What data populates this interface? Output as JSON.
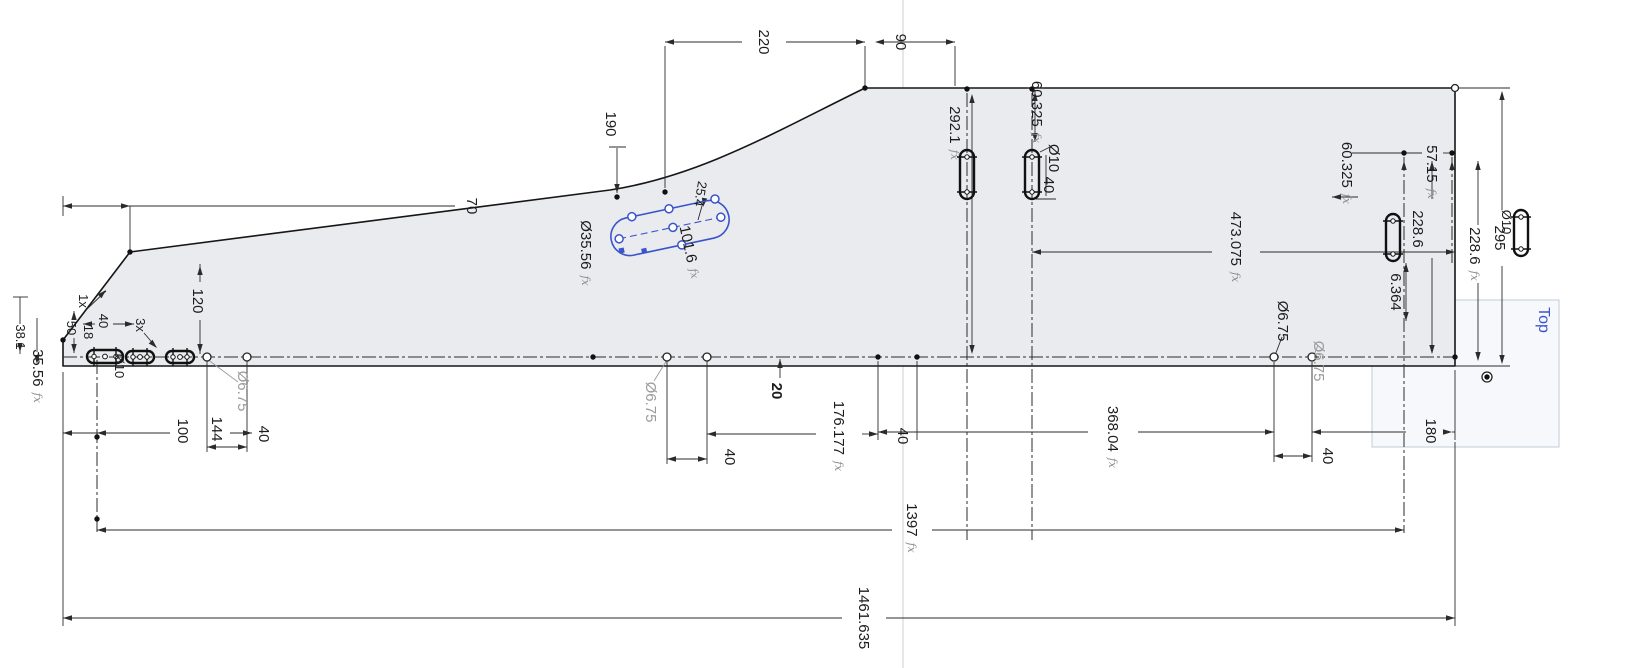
{
  "view": {
    "width": 1625,
    "height": 668,
    "background": "#ffffff"
  },
  "colors": {
    "outline": "#161616",
    "dim": "#2b2b2b",
    "gray_label": "#9b9b9b",
    "fx": "#8f8f8f",
    "blue": "#3a55cc",
    "fill": "#e9ebee",
    "axis": "#d4d7da",
    "plane_fill": "#eef3f8",
    "plane_stroke": "#c2cbd8"
  },
  "plane_label": {
    "text": "Top"
  },
  "labels": [
    {
      "name": "dim-70",
      "text": "70",
      "x": 472,
      "y": 206
    },
    {
      "name": "dim-190",
      "text": "190",
      "x": 611,
      "y": 124
    },
    {
      "name": "dim-220",
      "text": "220",
      "x": 764,
      "y": 42
    },
    {
      "name": "dim-90",
      "text": "90",
      "x": 901,
      "y": 42
    },
    {
      "name": "dim-25.4",
      "text": "25.4",
      "x": 701,
      "y": 194,
      "size": 13,
      "rot": 100
    },
    {
      "name": "dim-dia35.56",
      "text": "Ø35.56",
      "x": 586,
      "y": 253,
      "fx": true
    },
    {
      "name": "dim-101.6",
      "text": "101.6",
      "x": 690,
      "y": 252,
      "fx": true,
      "rot": 78
    },
    {
      "name": "dim-120",
      "text": "120",
      "x": 198,
      "y": 301
    },
    {
      "name": "note-1x",
      "text": "1x",
      "x": 84,
      "y": 301,
      "size": 13
    },
    {
      "name": "dim-50",
      "text": "50",
      "x": 72,
      "y": 328,
      "size": 13
    },
    {
      "name": "dim-18",
      "text": "18",
      "x": 89,
      "y": 332,
      "size": 13
    },
    {
      "name": "dim-40-tl",
      "text": "40",
      "x": 104,
      "y": 321,
      "size": 13
    },
    {
      "name": "note-3x",
      "text": "3x",
      "x": 141,
      "y": 325,
      "size": 13
    },
    {
      "name": "dim-dia10-l",
      "text": "Ø10",
      "x": 120,
      "y": 366,
      "size": 13
    },
    {
      "name": "dim-38.1",
      "text": "38.1",
      "x": 21,
      "y": 337,
      "size": 13
    },
    {
      "name": "dim-35.56",
      "text": "35.56",
      "x": 38,
      "y": 376,
      "fx": true
    },
    {
      "name": "dim-dia6.75-a",
      "text": "Ø6.75",
      "x": 243,
      "y": 391,
      "color": "#9b9b9b"
    },
    {
      "name": "dim-100",
      "text": "100",
      "x": 183,
      "y": 431
    },
    {
      "name": "dim-144",
      "text": "144",
      "x": 217,
      "y": 429
    },
    {
      "name": "dim-40-a",
      "text": "40",
      "x": 264,
      "y": 434
    },
    {
      "name": "dim-dia6.75-b",
      "text": "Ø6.75",
      "x": 651,
      "y": 402,
      "color": "#9b9b9b"
    },
    {
      "name": "dim-40-b",
      "text": "40",
      "x": 730,
      "y": 457
    },
    {
      "name": "dim-20",
      "text": "20",
      "x": 777,
      "y": 391,
      "bold": true
    },
    {
      "name": "dim-176.177",
      "text": "176.177",
      "x": 839,
      "y": 436,
      "fx": true
    },
    {
      "name": "dim-40-c",
      "text": "40",
      "x": 903,
      "y": 436
    },
    {
      "name": "dim-292.1",
      "text": "292.1",
      "x": 955,
      "y": 133,
      "fx": true
    },
    {
      "name": "dim-60.325-l",
      "text": "60.325",
      "x": 1037,
      "y": 112,
      "fx": true
    },
    {
      "name": "dim-dia10-m",
      "text": "Ø10",
      "x": 1054,
      "y": 158
    },
    {
      "name": "dim-40-d",
      "text": "40",
      "x": 1049,
      "y": 185
    },
    {
      "name": "dim-473.075",
      "text": "473.075",
      "x": 1236,
      "y": 247,
      "fx": true
    },
    {
      "name": "dim-dia6.75-c",
      "text": "Ø6.75",
      "x": 1283,
      "y": 321
    },
    {
      "name": "dim-dia6.75-d",
      "text": "Ø6.75",
      "x": 1319,
      "y": 361,
      "color": "#9b9b9b"
    },
    {
      "name": "dim-368.04",
      "text": "368.04",
      "x": 1113,
      "y": 437,
      "fx": true
    },
    {
      "name": "dim-40-e",
      "text": "40",
      "x": 1328,
      "y": 456
    },
    {
      "name": "dim-180",
      "text": "180",
      "x": 1431,
      "y": 431
    },
    {
      "name": "dim-60.325-r",
      "text": "60.325",
      "x": 1347,
      "y": 173,
      "fx": true
    },
    {
      "name": "dim-57.15",
      "text": "57.15",
      "x": 1432,
      "y": 172,
      "fx": true
    },
    {
      "name": "dim-228.6-a",
      "text": "228.6",
      "x": 1418,
      "y": 229
    },
    {
      "name": "dim-228.6-b",
      "text": "228.6",
      "x": 1475,
      "y": 254,
      "fx": true
    },
    {
      "name": "dim-295",
      "text": "295",
      "x": 1500,
      "y": 238
    },
    {
      "name": "dim-6.364",
      "text": "6.364",
      "x": 1396,
      "y": 292
    },
    {
      "name": "dim-dia10-r",
      "text": "Ø10",
      "x": 1507,
      "y": 222,
      "size": 13
    },
    {
      "name": "dim-1397",
      "text": "1397",
      "x": 912,
      "y": 528,
      "fx": true
    },
    {
      "name": "dim-1461.635",
      "text": "1461.635",
      "x": 864,
      "y": 618
    },
    {
      "name": "top-plane-label",
      "text": "Top",
      "x": 1544,
      "y": 320,
      "color": "#3a55cc",
      "size": 16
    }
  ],
  "geometry": {
    "axis": [
      903,
      0,
      903,
      668
    ],
    "plane_rect": {
      "x": 1372,
      "y": 300,
      "w": 187,
      "h": 147
    },
    "outline": "M63 340 L130 252 L610 190 C700 176 775 132 865 88 L1455 88 L1455 366 L63 366 Z",
    "centerlines": [
      [
        63,
        357,
        1455,
        357
      ]
    ],
    "dashdot": [
      [
        97,
        360,
        97,
        532
      ],
      [
        967,
        93,
        967,
        540
      ],
      [
        1032,
        93,
        1032,
        540
      ],
      [
        1404,
        157,
        1404,
        533
      ],
      [
        1452,
        157,
        1452,
        263
      ]
    ],
    "segments": [
      [
        63,
        196,
        63,
        216
      ],
      [
        130,
        206,
        130,
        250
      ],
      [
        63,
        206,
        455,
        206
      ],
      [
        665,
        42,
        742,
        42
      ],
      [
        786,
        42,
        865,
        42
      ],
      [
        880,
        42,
        955,
        42
      ],
      [
        665,
        46,
        665,
        188
      ],
      [
        865,
        46,
        865,
        86
      ],
      [
        955,
        46,
        955,
        86
      ],
      [
        617,
        148,
        617,
        193
      ],
      [
        609,
        147,
        626,
        147
      ],
      [
        200,
        264,
        200,
        282
      ],
      [
        200,
        320,
        200,
        354
      ],
      [
        74,
        311,
        74,
        316
      ],
      [
        74,
        338,
        74,
        353
      ],
      [
        83,
        324,
        95,
        324
      ],
      [
        113,
        324,
        134,
        324
      ],
      [
        87,
        309,
        106,
        291
      ],
      [
        144,
        333,
        156,
        347
      ],
      [
        20,
        297,
        20,
        324
      ],
      [
        20,
        350,
        20,
        354
      ],
      [
        13,
        297,
        28,
        297
      ],
      [
        37,
        318,
        37,
        352
      ],
      [
        63,
        433,
        170,
        433
      ],
      [
        230,
        433,
        252,
        433
      ],
      [
        207,
        361,
        207,
        452
      ],
      [
        247,
        361,
        247,
        452
      ],
      [
        207,
        447,
        247,
        447
      ],
      [
        667,
        361,
        667,
        464
      ],
      [
        707,
        361,
        707,
        464
      ],
      [
        667,
        459,
        707,
        459
      ],
      [
        780,
        359,
        780,
        378
      ],
      [
        707,
        434,
        816,
        434
      ],
      [
        862,
        434,
        878,
        434
      ],
      [
        878,
        361,
        878,
        440
      ],
      [
        917,
        361,
        917,
        440
      ],
      [
        878,
        432,
        1088,
        432
      ],
      [
        1138,
        432,
        1274,
        432
      ],
      [
        1274,
        362,
        1274,
        462
      ],
      [
        1312,
        362,
        1312,
        462
      ],
      [
        1274,
        456,
        1312,
        456
      ],
      [
        1312,
        432,
        1406,
        432
      ],
      [
        1452,
        432,
        1455,
        432
      ],
      [
        1455,
        370,
        1455,
        440
      ],
      [
        1032,
        252,
        1212,
        252
      ],
      [
        1260,
        252,
        1455,
        252
      ],
      [
        972,
        96,
        972,
        352
      ],
      [
        1035,
        90,
        1035,
        142
      ],
      [
        1027,
        88,
        1044,
        88
      ],
      [
        1040,
        152,
        1052,
        146
      ],
      [
        1046,
        155,
        1046,
        196
      ],
      [
        1036,
        199,
        1056,
        199
      ],
      [
        1352,
        153,
        1422,
        153
      ],
      [
        1443,
        153,
        1452,
        153
      ],
      [
        1332,
        197,
        1358,
        197
      ],
      [
        1432,
        161,
        1432,
        199
      ],
      [
        1432,
        258,
        1432,
        353
      ],
      [
        1478,
        161,
        1478,
        225
      ],
      [
        1478,
        283,
        1478,
        360
      ],
      [
        1502,
        92,
        1502,
        210
      ],
      [
        1502,
        266,
        1502,
        363
      ],
      [
        1455,
        88,
        1510,
        88
      ],
      [
        1455,
        366,
        1510,
        366
      ],
      [
        1406,
        263,
        1406,
        321
      ],
      [
        97,
        530,
        892,
        530
      ],
      [
        932,
        530,
        1404,
        530
      ],
      [
        63,
        618,
        842,
        618
      ],
      [
        886,
        618,
        1455,
        618
      ],
      [
        63,
        372,
        63,
        626
      ],
      [
        1455,
        442,
        1455,
        626
      ],
      [
        702,
        206,
        698,
        220
      ],
      [
        1274,
        358,
        1282,
        337
      ]
    ],
    "gray_segments": [
      [
        207,
        359,
        238,
        382
      ],
      [
        667,
        360,
        654,
        381
      ],
      [
        1312,
        360,
        1318,
        345
      ]
    ],
    "arrows": [
      [
        63,
        206,
        180
      ],
      [
        130,
        206,
        0
      ],
      [
        665,
        42,
        180
      ],
      [
        865,
        42,
        0
      ],
      [
        875,
        42,
        180
      ],
      [
        955,
        42,
        0
      ],
      [
        617,
        193,
        90
      ],
      [
        200,
        266,
        270
      ],
      [
        200,
        353,
        90
      ],
      [
        74,
        311,
        270
      ],
      [
        74,
        353,
        90
      ],
      [
        83,
        324,
        180
      ],
      [
        134,
        324,
        0
      ],
      [
        106,
        290,
        315
      ],
      [
        157,
        348,
        45
      ],
      [
        20,
        352,
        90
      ],
      [
        37,
        364,
        90
      ],
      [
        63,
        433,
        180
      ],
      [
        252,
        433,
        0
      ],
      [
        97,
        433,
        180
      ],
      [
        207,
        447,
        180
      ],
      [
        247,
        447,
        0
      ],
      [
        667,
        459,
        180
      ],
      [
        707,
        459,
        0
      ],
      [
        780,
        359,
        270
      ],
      [
        707,
        434,
        180
      ],
      [
        878,
        434,
        0
      ],
      [
        878,
        432,
        180
      ],
      [
        1274,
        432,
        0
      ],
      [
        1274,
        456,
        180
      ],
      [
        1312,
        456,
        0
      ],
      [
        1312,
        432,
        180
      ],
      [
        1452,
        432,
        0
      ],
      [
        1032,
        252,
        180
      ],
      [
        1455,
        252,
        0
      ],
      [
        972,
        94,
        270
      ],
      [
        972,
        354,
        90
      ],
      [
        1035,
        92,
        270
      ],
      [
        1035,
        142,
        90
      ],
      [
        1404,
        161,
        270
      ],
      [
        1452,
        161,
        270
      ],
      [
        1332,
        197,
        180
      ],
      [
        1432,
        161,
        270
      ],
      [
        1432,
        354,
        90
      ],
      [
        1478,
        161,
        270
      ],
      [
        1478,
        361,
        90
      ],
      [
        1502,
        91,
        270
      ],
      [
        1502,
        364,
        90
      ],
      [
        1406,
        263,
        270
      ],
      [
        1406,
        321,
        90
      ],
      [
        97,
        530,
        180
      ],
      [
        1404,
        530,
        0
      ],
      [
        63,
        618,
        180
      ],
      [
        1455,
        618,
        0
      ],
      [
        703,
        207,
        100
      ]
    ],
    "slots": [
      {
        "x": 960,
        "y": 150,
        "w": 14,
        "h": 49
      },
      {
        "x": 1025,
        "y": 150,
        "w": 14,
        "h": 49
      },
      {
        "x": 1386,
        "y": 214,
        "w": 14,
        "h": 47
      },
      {
        "x": 1514,
        "y": 210,
        "w": 14,
        "h": 46
      },
      {
        "x": 87,
        "y": 350,
        "w": 36,
        "h": 13
      },
      {
        "x": 126,
        "y": 351,
        "w": 28,
        "h": 12
      },
      {
        "x": 166,
        "y": 351,
        "w": 28,
        "h": 12
      }
    ],
    "circles": [
      [
        207,
        357,
        4
      ],
      [
        247,
        357,
        4
      ],
      [
        667,
        357,
        4
      ],
      [
        707,
        357,
        4
      ],
      [
        1274,
        357,
        4
      ],
      [
        1312,
        357,
        4
      ],
      [
        1455,
        88,
        3.5
      ],
      [
        1487,
        377,
        5
      ]
    ],
    "dots": [
      [
        63,
        340
      ],
      [
        130,
        252
      ],
      [
        617,
        197
      ],
      [
        665,
        192
      ],
      [
        865,
        88
      ],
      [
        967,
        89
      ],
      [
        1032,
        89
      ],
      [
        593,
        357
      ],
      [
        878,
        357
      ],
      [
        917,
        357
      ],
      [
        97,
        437
      ],
      [
        97,
        519
      ],
      [
        1404,
        153
      ],
      [
        1452,
        153
      ],
      [
        1455,
        357
      ],
      [
        1487,
        377
      ]
    ]
  },
  "blue_sketch": {
    "cx": 670,
    "cy": 228,
    "angle": -12,
    "len": 120,
    "hgt": 38,
    "circles": [
      [
        52,
        0
      ],
      [
        50,
        -19
      ],
      [
        3,
        -19
      ],
      [
        3,
        0
      ],
      [
        -35,
        -19
      ],
      [
        8,
        19
      ],
      [
        -52,
        0
      ]
    ],
    "squares": [
      [
        -52,
        12
      ],
      [
        -30,
        17
      ]
    ]
  }
}
